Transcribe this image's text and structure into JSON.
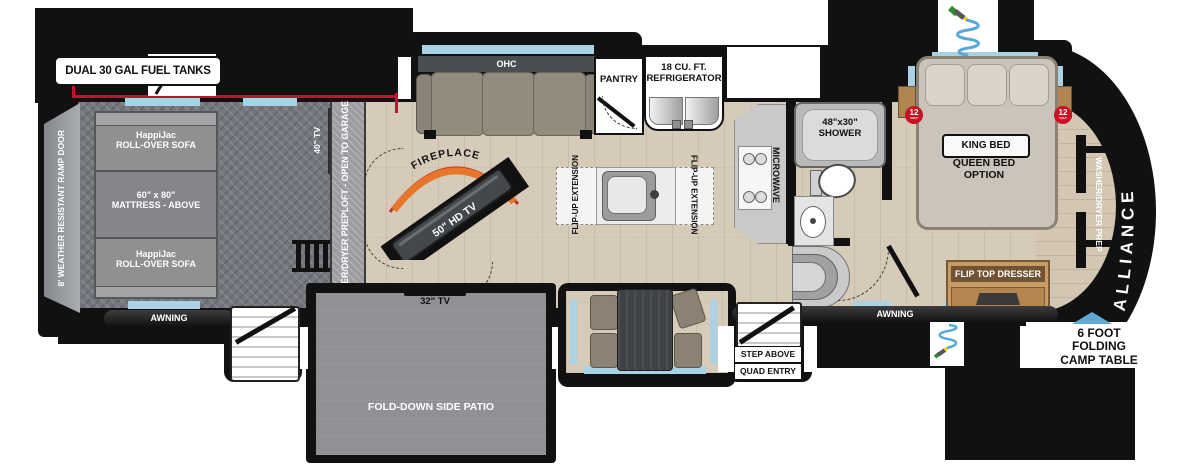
{
  "brand": "ALLIANCE",
  "fuel": {
    "label": "DUAL 30 GAL FUEL TANKS"
  },
  "garage": {
    "ramp_door": "8' WEATHER RESISTANT RAMP DOOR",
    "sofa_top_line1": "HappiJac",
    "sofa_top_line2": "ROLL-OVER SOFA",
    "mattress_line1": "60\" x 80\"",
    "mattress_line2": "MATTRESS - ABOVE",
    "sofa_bottom_line1": "HappiJac",
    "sofa_bottom_line2": "ROLL-OVER SOFA",
    "tv": "40\" TV",
    "loft_line1": "WASHER/DRYER PREP",
    "loft_line2": "LOFT - OPEN TO GARAGE"
  },
  "living": {
    "ohc": "OHC",
    "pantry": "PANTRY",
    "fridge_line1": "18 CU. FT.",
    "fridge_line2": "REFRIGERATOR",
    "fireplace": "FIREPLACE",
    "tv": "50\" HD TV",
    "island_flip_left": "FLIP-UP EXTENSION",
    "island_flip_right": "FLIP-UP EXTENSION",
    "microwave": "MICROWAVE"
  },
  "bath": {
    "shower_line1": "48\"x30\"",
    "shower_line2": "SHOWER"
  },
  "bedroom": {
    "king_bed": "KING BED",
    "queen_line1": "QUEEN BED",
    "queen_line2": "OPTION",
    "dresser": "FLIP TOP DRESSER",
    "wardrobe": "WASHER/DRYER PREP",
    "volt_num": "12",
    "volt_sub": "VOLT"
  },
  "exterior": {
    "awning_left": "AWNING",
    "awning_right": "AWNING",
    "patio_tv": "32\" TV",
    "patio": "FOLD-DOWN SIDE PATIO",
    "step_line1": "STEP ABOVE",
    "step_line2": "QUAD ENTRY",
    "camp_line1": "6 FOOT",
    "camp_line2": "FOLDING",
    "camp_line3": "CAMP TABLE"
  },
  "colors": {
    "accent_red": "#c8102e",
    "window_blue": "#a9d2e4",
    "fireplace_orange": "#e8762a",
    "wood": "#d6cbb9",
    "garage_gray": "#74777d",
    "silhouette": "#111111"
  }
}
